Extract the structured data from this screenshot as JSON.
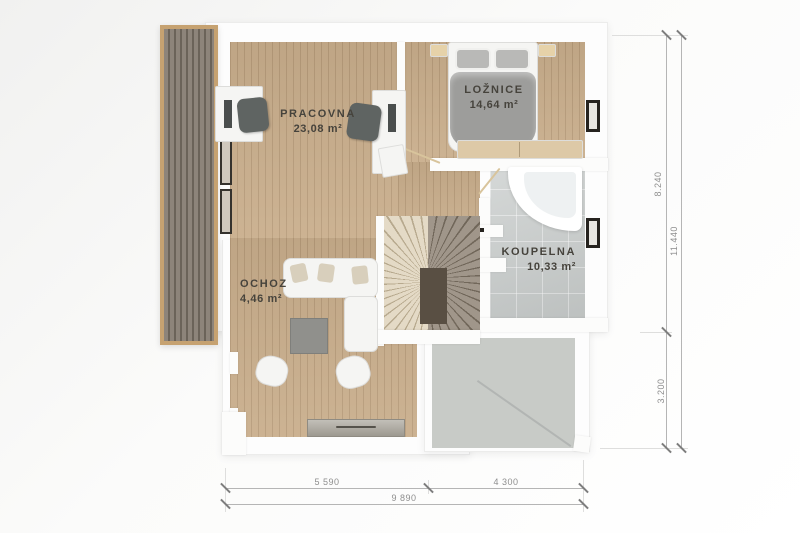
{
  "plan": {
    "type": "floor-plan",
    "floor": "upper",
    "rooms": {
      "pracovna": {
        "name": "PRACOVNA",
        "area": "23,08 m²"
      },
      "loznice": {
        "name": "LOŽNICE",
        "area": "14,64 m²"
      },
      "koupelna": {
        "name": "KOUPELNA",
        "area": "10,33 m²"
      },
      "ochoz": {
        "name": "OCHOZ",
        "area": "4,46 m²"
      }
    },
    "furniture": [
      "desk",
      "desk",
      "office-chair",
      "office-chair",
      "double-bed",
      "nightstand",
      "nightstand",
      "dresser",
      "corner-bathtub",
      "winder-staircase",
      "corner-sofa",
      "coffee-table",
      "armchair",
      "armchair",
      "sideboard"
    ],
    "exterior": [
      "slatted-balcony-deck",
      "lower-roof-terrace"
    ]
  },
  "dims": {
    "r_top": "8.240",
    "r_bottom": "3.200",
    "r_total": "11.440",
    "b_left": "5 590",
    "b_right": "4 300",
    "b_total": "9 890"
  },
  "colors": {
    "wood_floor": "#c9ae8c",
    "balcony_frame": "#c6a271",
    "balcony_slats": "#8d847a",
    "tile_floor": "#c7cbca",
    "roof_gray": "#c8cbc7",
    "wall_white": "#fdfdfd",
    "stairs_light": "#e4dac6",
    "stairs_dark": "#a0968a",
    "label_text": "#46433c",
    "dimension_text": "#8e8e8e"
  }
}
